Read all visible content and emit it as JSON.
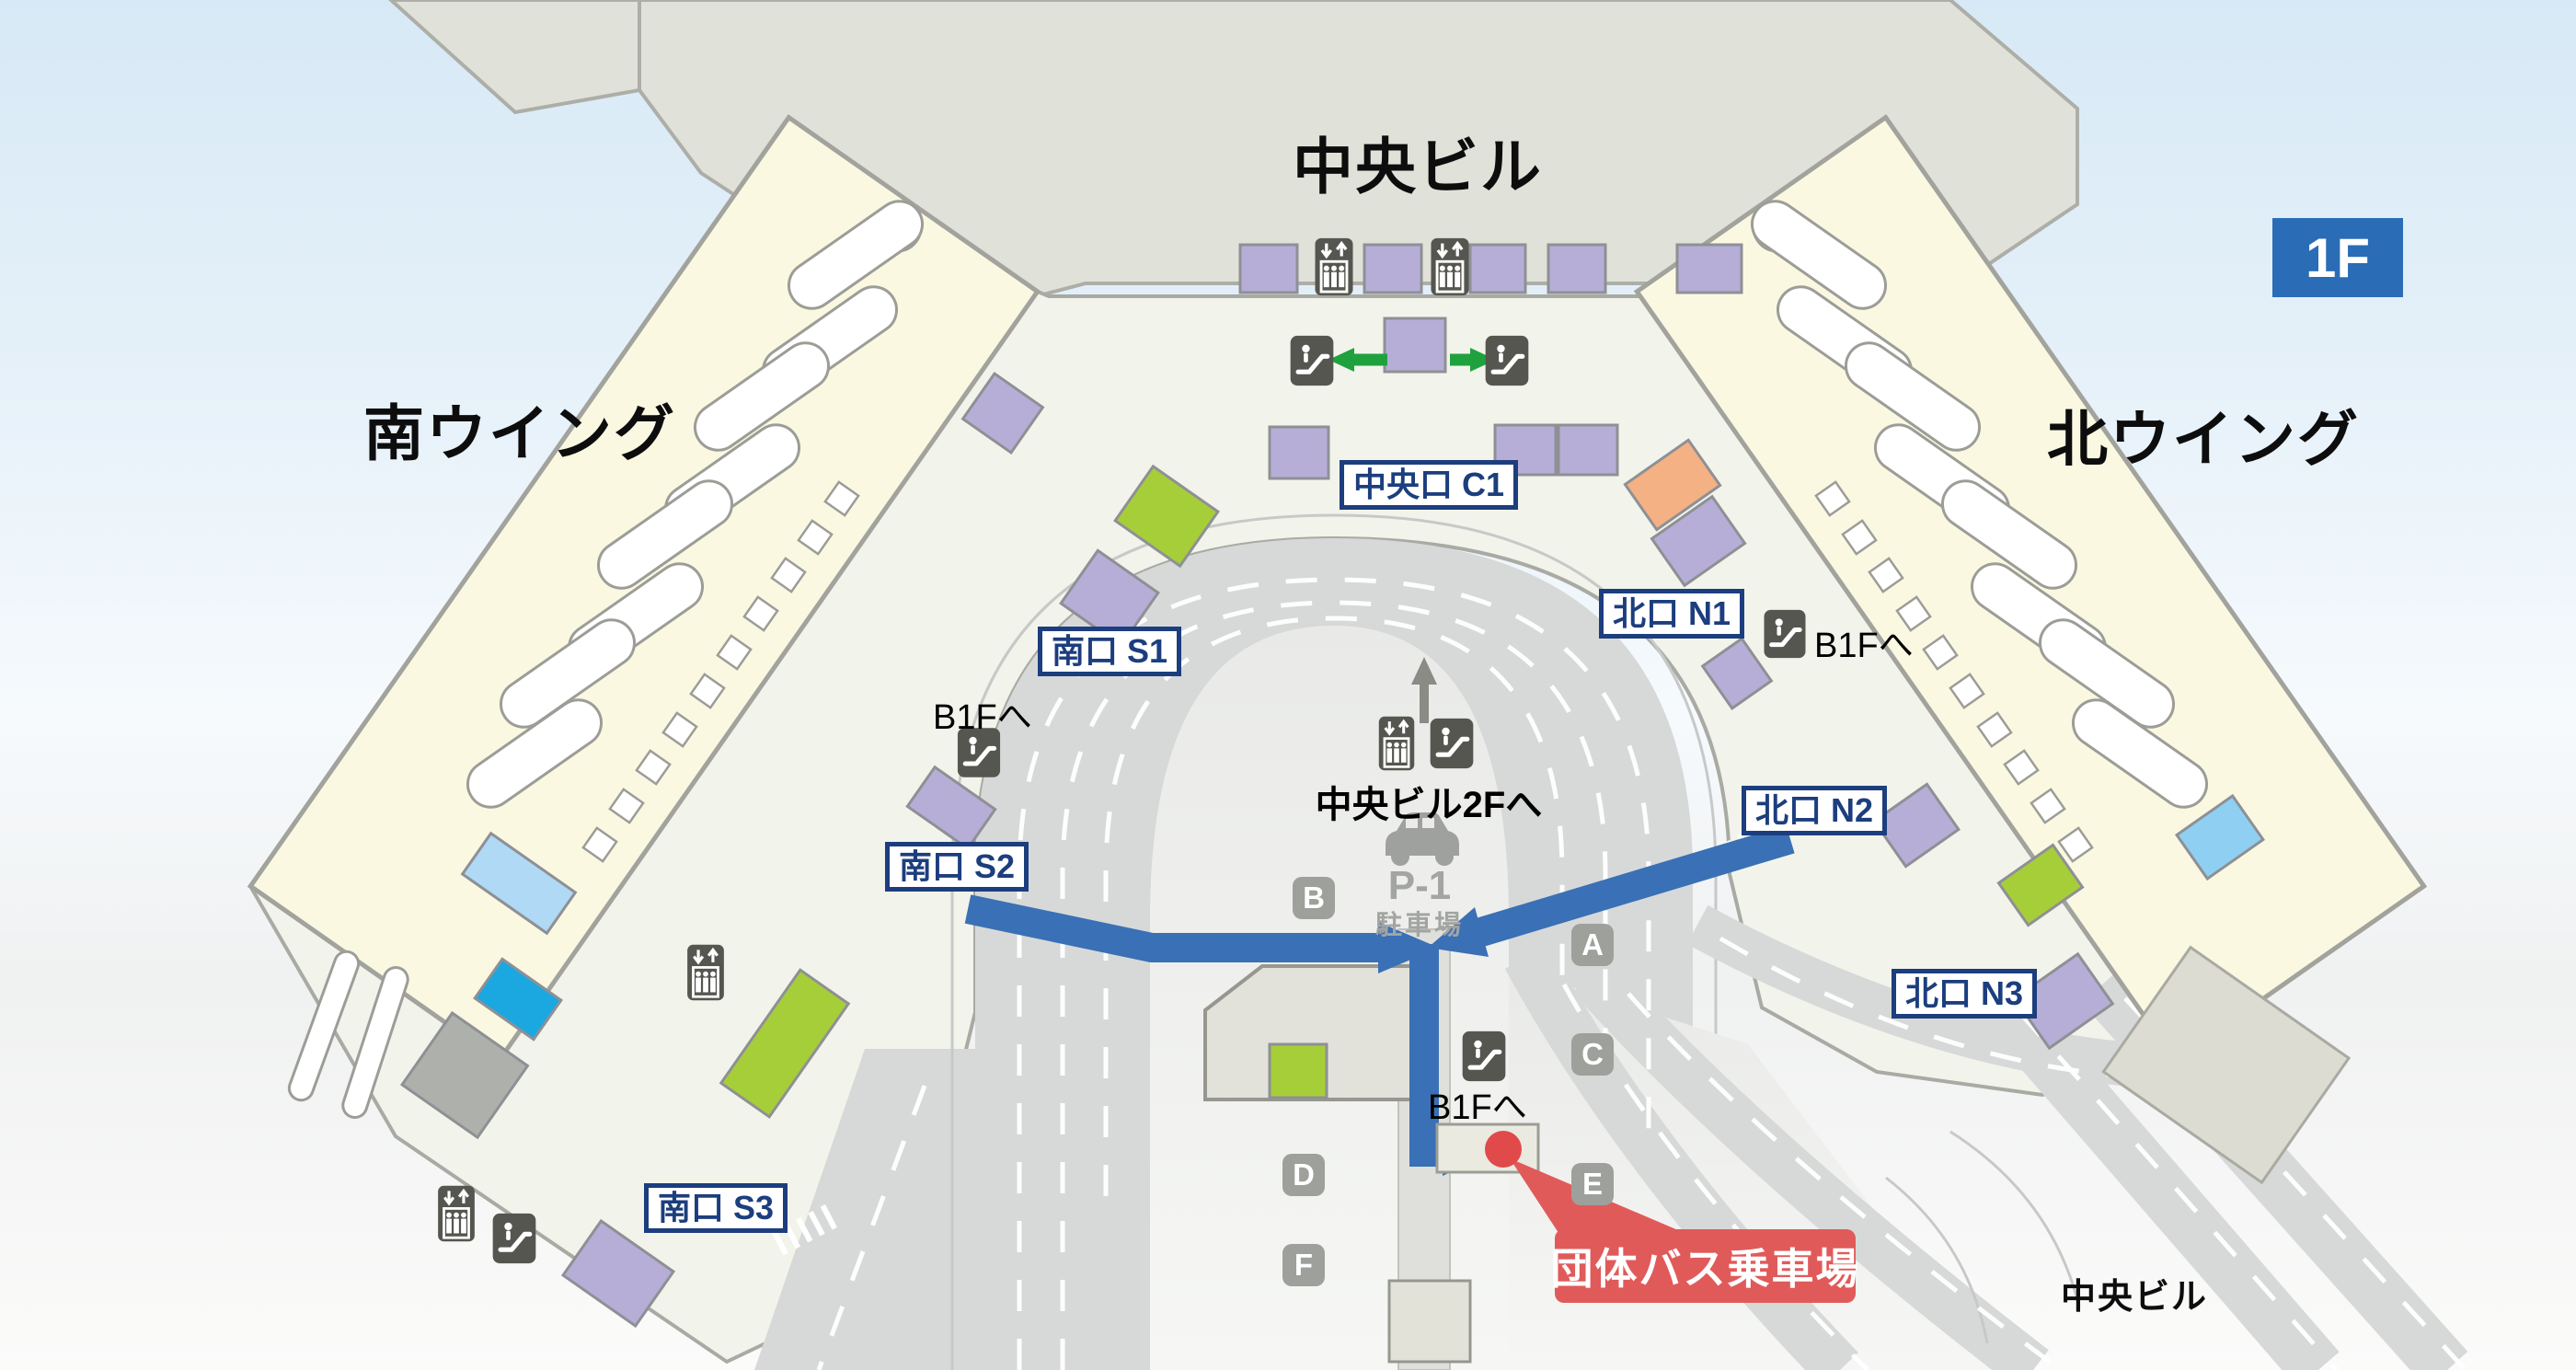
{
  "floor_badge": "1F",
  "titles": {
    "central_building_top": "中央ビル",
    "south_wing": "南ウイング",
    "north_wing": "北ウイング",
    "central_building_bottom": "中央ビル"
  },
  "gates": {
    "c1": "中央口 C1",
    "n1": "北口 N1",
    "n2": "北口 N2",
    "n3": "北口 N3",
    "s1": "南口 S1",
    "s2": "南口 S2",
    "s3": "南口 S3"
  },
  "signs": {
    "to_b1f": "B1Fへ",
    "to_central_2f": "中央ビル2Fへ"
  },
  "parking": {
    "name": "P-1",
    "caption": "駐車場"
  },
  "bus_stops": {
    "a": "A",
    "b": "B",
    "c": "C",
    "d": "D",
    "e": "E",
    "f": "F"
  },
  "callout": {
    "group_bus_stop": "団体バス乗車場"
  },
  "icons": {
    "elevator": "elevator-icon",
    "escalator": "escalator-icon",
    "car": "car-icon",
    "up_arrow": "up-arrow-icon"
  },
  "colors": {
    "route_blue": "#3a70b5",
    "badge_blue": "#2a6cb5",
    "callout_red": "#e15a5a",
    "marker_red": "#e04a4a",
    "gate_navy": "#1c3e7e",
    "counter_purple": "#b6aed7",
    "counter_green": "#a6ce39",
    "counter_orange": "#f4b183",
    "counter_cyan": "#1ba8e0",
    "wing_yellow": "#fbf8e2",
    "floor_light": "#f2f4eb",
    "road_gray": "#d7d9d8",
    "link_green": "#1fa23e"
  }
}
